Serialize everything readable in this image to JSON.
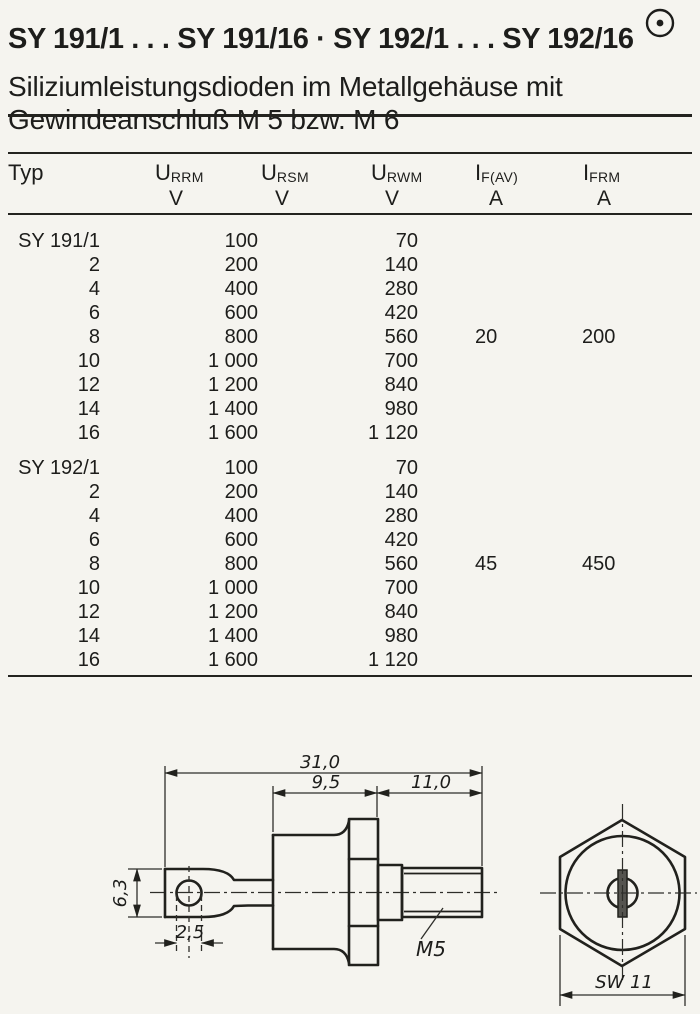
{
  "header": {
    "title": "SY 191/1 . . . SY 191/16 · SY 192/1 . . . SY 192/16",
    "subtitle_line1": "Siliziumleistungsdioden im Metallgehäuse mit",
    "subtitle_line2": "Gewindeanschluß M 5 bzw. M 6",
    "corner_icon": "circled-dot-icon"
  },
  "table": {
    "columns": [
      {
        "symbol": "Typ",
        "sub": "",
        "unit": ""
      },
      {
        "symbol": "U",
        "sub": "RRM",
        "unit": "V"
      },
      {
        "symbol": "U",
        "sub": "RSM",
        "unit": "V"
      },
      {
        "symbol": "U",
        "sub": "RWM",
        "unit": "V"
      },
      {
        "symbol": "I",
        "sub": "F(AV)",
        "unit": "A"
      },
      {
        "symbol": "I",
        "sub": "FRM",
        "unit": "A"
      }
    ],
    "blocks": [
      {
        "if_av": "20",
        "ifrm": "200",
        "rows": [
          {
            "typ": "SY 191/1",
            "urrm": "100",
            "urwm": "70"
          },
          {
            "typ": "2",
            "urrm": "200",
            "urwm": "140"
          },
          {
            "typ": "4",
            "urrm": "400",
            "urwm": "280"
          },
          {
            "typ": "6",
            "urrm": "600",
            "urwm": "420"
          },
          {
            "typ": "8",
            "urrm": "800",
            "urwm": "560"
          },
          {
            "typ": "10",
            "urrm": "1 000",
            "urwm": "700"
          },
          {
            "typ": "12",
            "urrm": "1 200",
            "urwm": "840"
          },
          {
            "typ": "14",
            "urrm": "1 400",
            "urwm": "980"
          },
          {
            "typ": "16",
            "urrm": "1 600",
            "urwm": "1 120"
          }
        ]
      },
      {
        "if_av": "45",
        "ifrm": "450",
        "rows": [
          {
            "typ": "SY 192/1",
            "urrm": "100",
            "urwm": "70"
          },
          {
            "typ": "2",
            "urrm": "200",
            "urwm": "140"
          },
          {
            "typ": "4",
            "urrm": "400",
            "urwm": "280"
          },
          {
            "typ": "6",
            "urrm": "600",
            "urwm": "420"
          },
          {
            "typ": "8",
            "urrm": "800",
            "urwm": "560"
          },
          {
            "typ": "10",
            "urrm": "1 000",
            "urwm": "700"
          },
          {
            "typ": "12",
            "urrm": "1 200",
            "urwm": "840"
          },
          {
            "typ": "14",
            "urrm": "1 400",
            "urwm": "980"
          },
          {
            "typ": "16",
            "urrm": "1 600",
            "urwm": "1 120"
          }
        ]
      }
    ]
  },
  "drawing": {
    "side_view": {
      "dim_overall_length": "31,0",
      "dim_case_length": "9,5",
      "dim_thread_length": "11,0",
      "dim_lug_height": "6,3",
      "dim_hole_diameter": "2,5",
      "thread_label": "M5"
    },
    "end_view": {
      "wrench_size": "SW 11"
    }
  }
}
